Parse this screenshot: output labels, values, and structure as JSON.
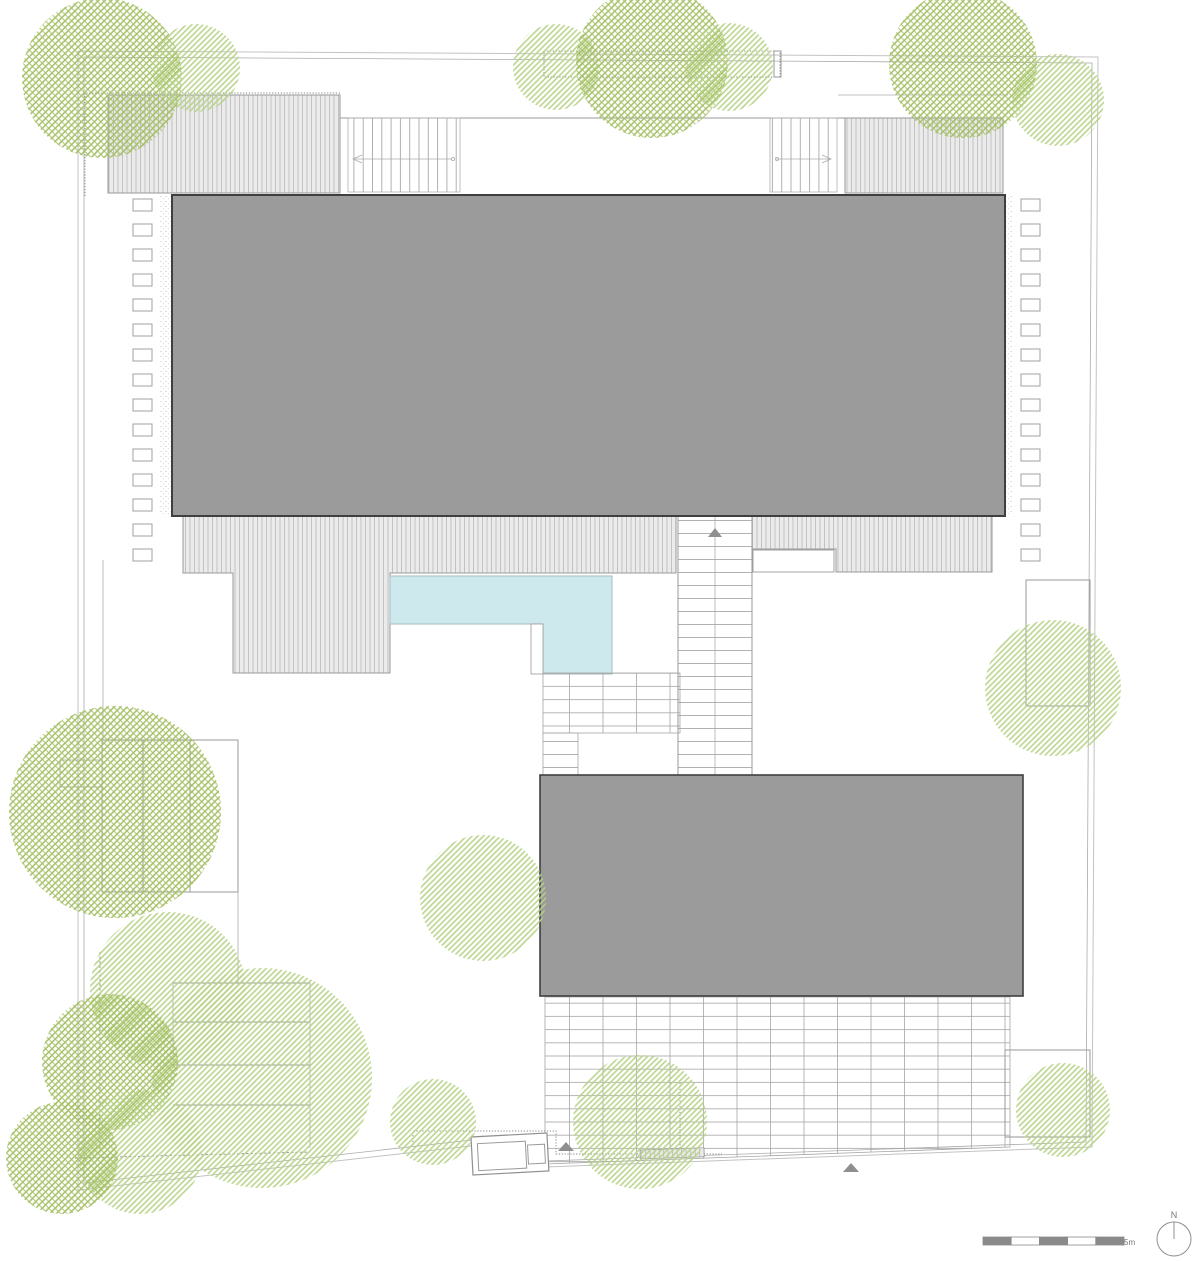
{
  "labels": {
    "scale": "5m",
    "north": "N"
  },
  "colors": {
    "background": "#ffffff",
    "roof_fill": "#9b9b9b",
    "roof_border": "#3f3f3f",
    "deck_fill": "#ebebeb",
    "deck_stripe": "#c2c2c2",
    "pool_fill": "#cde9ee",
    "pool_edge": "#a9babd",
    "tree_bright": "#b7d286",
    "tree_olive": "#a5c065",
    "line": "#9a9a9a",
    "arrow": "#8f8f8f",
    "scalebar": "#8a8a8a"
  },
  "plan": {
    "buildings": [
      {
        "name": "main-building-roof",
        "x": 172,
        "y": 195,
        "w": 833,
        "h": 321,
        "border": 2
      },
      {
        "name": "lower-building-roof",
        "x": 540,
        "y": 775,
        "w": 483,
        "h": 221,
        "border": 1.6
      }
    ],
    "pool": {
      "points": "390,576 612,576 612,674 543,674 543,624 390,624"
    },
    "trees": [
      {
        "cx": 102,
        "cy": 78,
        "r": 80,
        "variant": "olive"
      },
      {
        "cx": 196,
        "cy": 68,
        "r": 44,
        "variant": "bright"
      },
      {
        "cx": 556,
        "cy": 67,
        "r": 43,
        "variant": "bright"
      },
      {
        "cx": 652,
        "cy": 62,
        "r": 76,
        "variant": "olive"
      },
      {
        "cx": 729,
        "cy": 67,
        "r": 44,
        "variant": "bright"
      },
      {
        "cx": 963,
        "cy": 64,
        "r": 74,
        "variant": "olive"
      },
      {
        "cx": 1058,
        "cy": 100,
        "r": 46,
        "variant": "bright"
      },
      {
        "cx": 1053,
        "cy": 688,
        "r": 68,
        "variant": "bright"
      },
      {
        "cx": 483,
        "cy": 898,
        "r": 63,
        "variant": "bright"
      },
      {
        "cx": 115,
        "cy": 812,
        "r": 106,
        "variant": "olive"
      },
      {
        "cx": 168,
        "cy": 990,
        "r": 78,
        "variant": "bright"
      },
      {
        "cx": 262,
        "cy": 1078,
        "r": 110,
        "variant": "bright"
      },
      {
        "cx": 110,
        "cy": 1062,
        "r": 68,
        "variant": "olive"
      },
      {
        "cx": 140,
        "cy": 1152,
        "r": 62,
        "variant": "bright"
      },
      {
        "cx": 62,
        "cy": 1158,
        "r": 56,
        "variant": "olive"
      },
      {
        "cx": 433,
        "cy": 1122,
        "r": 43,
        "variant": "bright"
      },
      {
        "cx": 640,
        "cy": 1122,
        "r": 67,
        "variant": "bright"
      },
      {
        "cx": 1063,
        "cy": 1110,
        "r": 47,
        "variant": "bright"
      }
    ],
    "stepping_stones": [
      {
        "x": 133,
        "y": 199,
        "w": 19,
        "h": 12,
        "gap": 13,
        "count": 15
      },
      {
        "x": 1021,
        "y": 199,
        "w": 19,
        "h": 12,
        "gap": 13,
        "count": 15
      }
    ],
    "scalebar": {
      "x": 983,
      "y": 1237,
      "seg_w": 28.2,
      "h": 8,
      "segments": 5
    }
  }
}
